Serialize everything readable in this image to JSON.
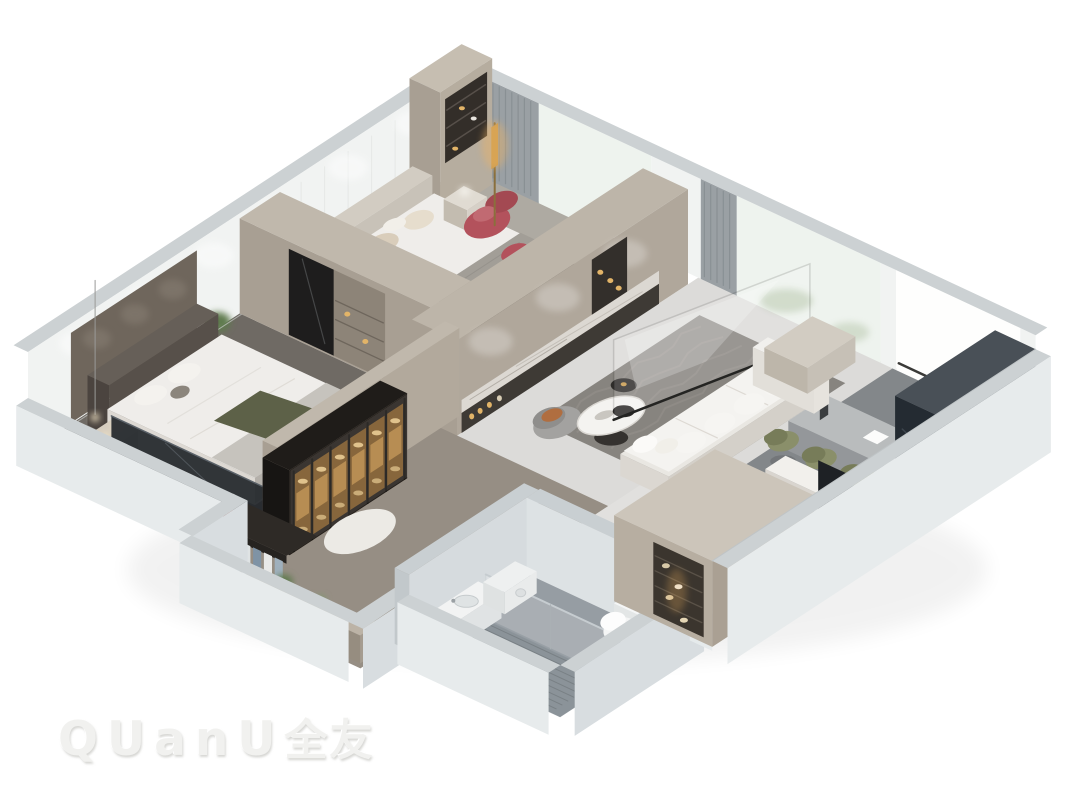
{
  "scene": {
    "style": "isometric-cutaway-3d-floorplan-render",
    "background": "#ffffff",
    "rooms": [
      "master-bedroom",
      "master-balcony",
      "walk-in-closet",
      "second-bedroom",
      "living-room",
      "dining-area",
      "kitchen",
      "bathroom",
      "entry-hall"
    ],
    "furniture": [
      "master-bed",
      "pendant-lamp",
      "clothes-rack",
      "glass-display-wardrobe",
      "dressing-counter",
      "second-bed",
      "wardrobe",
      "red-armchair",
      "red-ottoman",
      "gold-floor-lamp",
      "tv-media-wall",
      "sectional-sofa",
      "oval-coffee-table",
      "round-side-table",
      "gray-armchair",
      "glass-partition",
      "dining-table",
      "olive-dining-chairs",
      "white-bench",
      "kitchen-cabinets",
      "shower-enclosure",
      "toilet",
      "vanity-sink",
      "washing-machine",
      "shoe-cabinet"
    ]
  },
  "watermark": {
    "latin": "QUanU",
    "cjk": "全友"
  },
  "colors": {
    "background": "#ffffff",
    "wall_cap": "#ccd1d3",
    "wall_outer": "#e7ebec",
    "wall_outer_dark": "#d8dde0",
    "wall_inner": "#f1f3f2",
    "wall_taupe": "#b2a99c",
    "wall_taupe_top": "#c0b8ac",
    "wall_taupe_dark": "#a89f93",
    "floor_light": "#dcdbd9",
    "floor_master": "#6f6a64",
    "floor_balcony": "#8a847c",
    "floor_bed2": "#aeaaa2",
    "floor_cloak": "#968e84",
    "floor_dining": "#83878a",
    "floor_bath": "#969da3",
    "floor_shower": "#8b9399",
    "floor_entry": "#e1e0de",
    "rug_living": "#87847f",
    "rug_texture": "#95928c",
    "rug_white": "#eceae5",
    "sofa_white": "#f4f3f0",
    "sofa_base": "#d4d0c9",
    "bed_white": "#efedea",
    "bed_shadow": "#d8d4ce",
    "blanket_gray": "#c6c3bd",
    "throw_gray": "#a29e97",
    "headboard_dark": "#57504a",
    "headboard_panel": "#6f665c",
    "pillow_beige": "#d9cdbb",
    "throw_green": "#5d6148",
    "accent_red": "#b3525c",
    "accent_red_dark": "#a34952",
    "accent_rust": "#b06e40",
    "accent_gold": "#c89a4e",
    "amber_glow": "#f2b45e",
    "amber_item": "#e2b468",
    "cabinet_glass_dark": "#241f1a",
    "cabinet_cell": "#7a5526",
    "cabinet_cell_light": "#b98a45",
    "mirror_dark": "#1e1d1d",
    "glazing_dark": "#24282c",
    "kitchen_dark": "#242b32",
    "kitchen_top": "#495057",
    "doorway_dark": "#1e2125",
    "chair_olive": "#8a8f6a",
    "chair_olive_dark": "#777c59",
    "plant_green": "#5f7a4e",
    "marble": "#dcd8d2",
    "media_base_dark": "#3e3a35",
    "table_gray": "#b9bcbd",
    "table_gray_side": "#94979a",
    "window_bright": "#fefefd",
    "window_sheer": "#eef3ee",
    "window_sill": "#3a3a38",
    "curtain_gray": "#9aa0a4",
    "curtain_pleat": "#868d91",
    "bath_wall": "#d6dbde",
    "metal": "#c6ccd0",
    "white_goods": "#eef0f0",
    "watermark": "#f1f1ef"
  }
}
